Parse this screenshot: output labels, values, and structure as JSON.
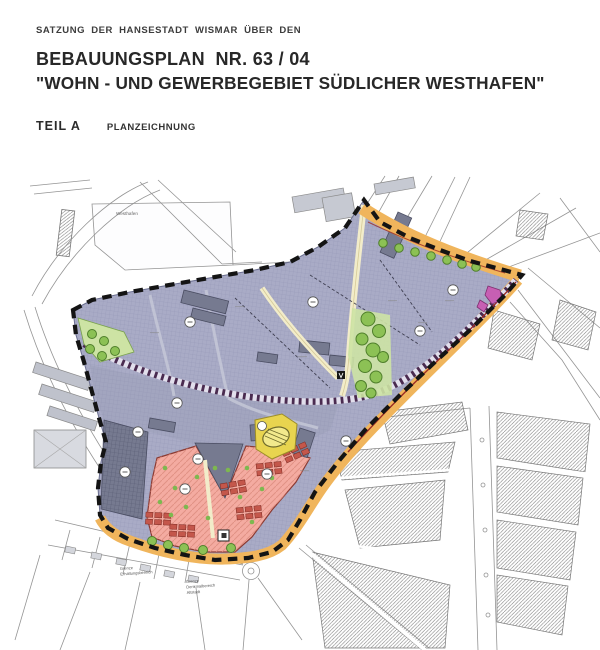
{
  "document": {
    "pretitle": "SATZUNG DER HANSESTADT WISMAR ÜBER DEN",
    "plan_number_title": "BEBAUUNGSPLAN  NR. 63 / 04",
    "plan_name_title": "\"WOHN - UND GEWERBEGEBIET SÜDLICHER WESTHAFEN\"",
    "part_label": "TEIL A",
    "part_title": "PLANZEICHNUNG"
  },
  "map": {
    "labels": {
      "harbor": "Westhafen",
      "preservation_note": {
        "line1": "Grenze",
        "line2": "Erhaltungsbereich"
      },
      "monument_note": {
        "line1": "Grenze",
        "line2": "Denkmalbereich",
        "line3": "Altstadt"
      }
    },
    "colors": {
      "commercial_zone": "#a9abc6",
      "commercial_zone_dark": "#767a90",
      "residential_zone": "#f4aba1",
      "road_zone": "#f0b55c",
      "path_zone": "#f2ecca",
      "green_zone": "#8cc155",
      "green_zone_light": "#cde3a4",
      "special_building_zone": "#e8d44f",
      "special_parcel": "#c75fb3",
      "railway_signature": "#4a2b50",
      "plan_boundary": "#141414",
      "building_red": "#c4574b"
    }
  }
}
